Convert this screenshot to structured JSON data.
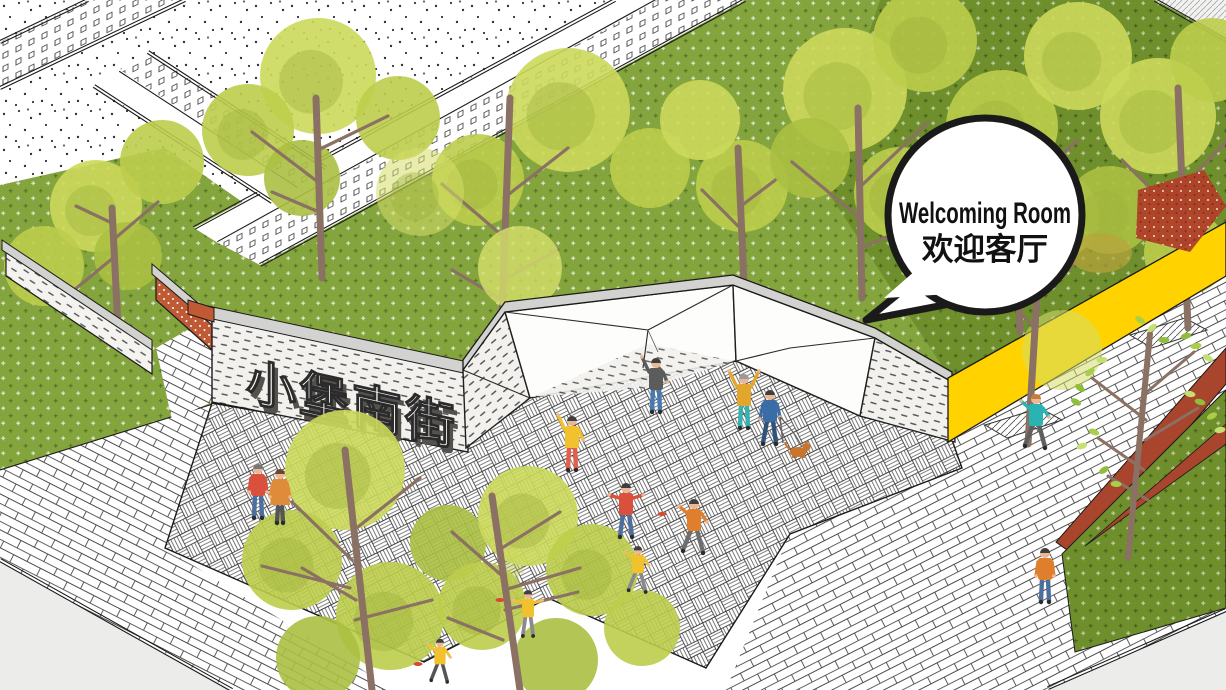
{
  "scene": {
    "type": "axonometric-park-illustration",
    "annotation_bubble": {
      "line1": "Welcoming Room",
      "line2": "欢迎客厅"
    },
    "street_sign": {
      "text": "小堡南街"
    }
  },
  "palette": {
    "outline": "#1a1a1a",
    "lawn_green": "#84a43d",
    "lawn_dark_green": "#6f8f2c",
    "tree_canopy_light": "#ccd95b",
    "tree_canopy_mid": "#bccd4b",
    "tree_canopy_deep": "#abc043",
    "tree_canopy_yellow": "#d6de6a",
    "trunk_brown": "#8a7163",
    "wall_red_orange": "#c05a35",
    "wall_yellow": "#ffd200",
    "corten_red": "#a8452c",
    "coping_gray": "#d2d2d0",
    "road_gray": "#ececea",
    "bubble_white": "#ffffff",
    "dog_orange": "#c8762e"
  }
}
